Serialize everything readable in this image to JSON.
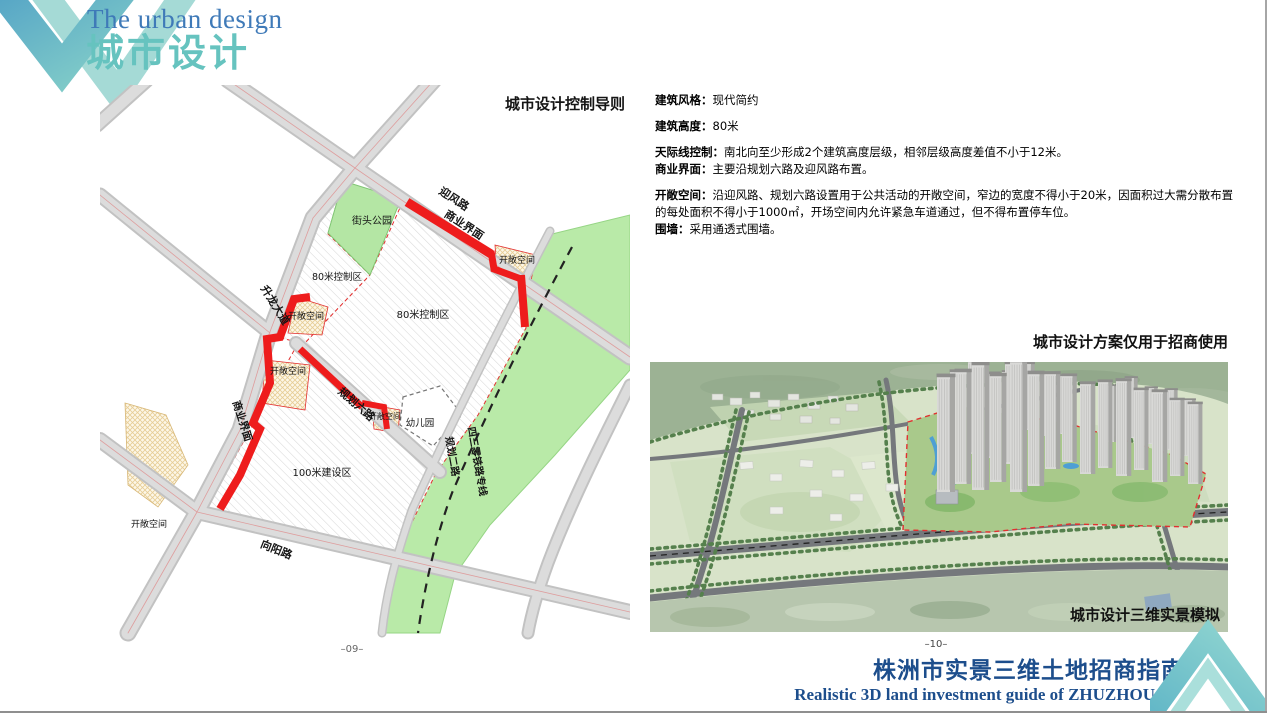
{
  "header": {
    "subtitle": "The urban design",
    "title": "城市设计"
  },
  "map": {
    "title": "城市设计控制导则",
    "page_number": "–09–",
    "labels": {
      "yingfeng_road": "迎风路",
      "commercial_top": "商业界面",
      "street_park": "街头公园",
      "open_space_ne": "开敞空间",
      "zone80_west": "80米控制区",
      "zone80_east": "80米控制区",
      "open_space_w": "开敞空间",
      "shenglong_ave": "升龙大道",
      "open_space_w2": "开敞空间",
      "commercial_left": "商业界面",
      "guihua6_road": "规划六路",
      "open_space_mid": "开敞空间",
      "kindergarten": "幼儿园",
      "zone100": "100米建设区",
      "guihua2_road": "规划二路",
      "railway_line": "四三零铁路专线",
      "xiangyang_road": "向阳路",
      "open_space_sw": "开敞空间"
    }
  },
  "specs": {
    "items": [
      {
        "label": "建筑风格：",
        "text": "现代简约"
      },
      {
        "label": "建筑高度：",
        "text": "80米"
      },
      {
        "label": "天际线控制：",
        "text": "南北向至少形成2个建筑高度层级，相邻层级高度差值不小于12米。"
      },
      {
        "label": "商业界面：",
        "text": "主要沿规划六路及迎风路布置。"
      },
      {
        "label": "开敞空间：",
        "text": "沿迎风路、规划六路设置用于公共活动的开敞空间，窄边的宽度不得小于20米，因面积过大需分散布置的每处面积不得小于1000㎡，开场空间内允许紧急车道通过，但不得布置停车位。"
      },
      {
        "label": "围墙：",
        "text": "采用通透式围墙。"
      }
    ]
  },
  "render": {
    "title": "城市设计方案仅用于招商使用",
    "caption": "城市设计三维实景模拟",
    "page_number": "–10–"
  },
  "footer": {
    "title_zh": "株洲市实景三维土地招商指南",
    "title_en": "Realistic 3D land investment guide of ZHUZHOU"
  },
  "colors": {
    "accent_teal": "#66c3bf",
    "accent_blue": "#3f7ab8",
    "footer_blue": "#1d4e8c",
    "commercial_red": "#ee1c1c",
    "park_green": "#b4e6a4",
    "railway_green": "#b9eaa8",
    "road_gray": "#d9d9d9"
  }
}
